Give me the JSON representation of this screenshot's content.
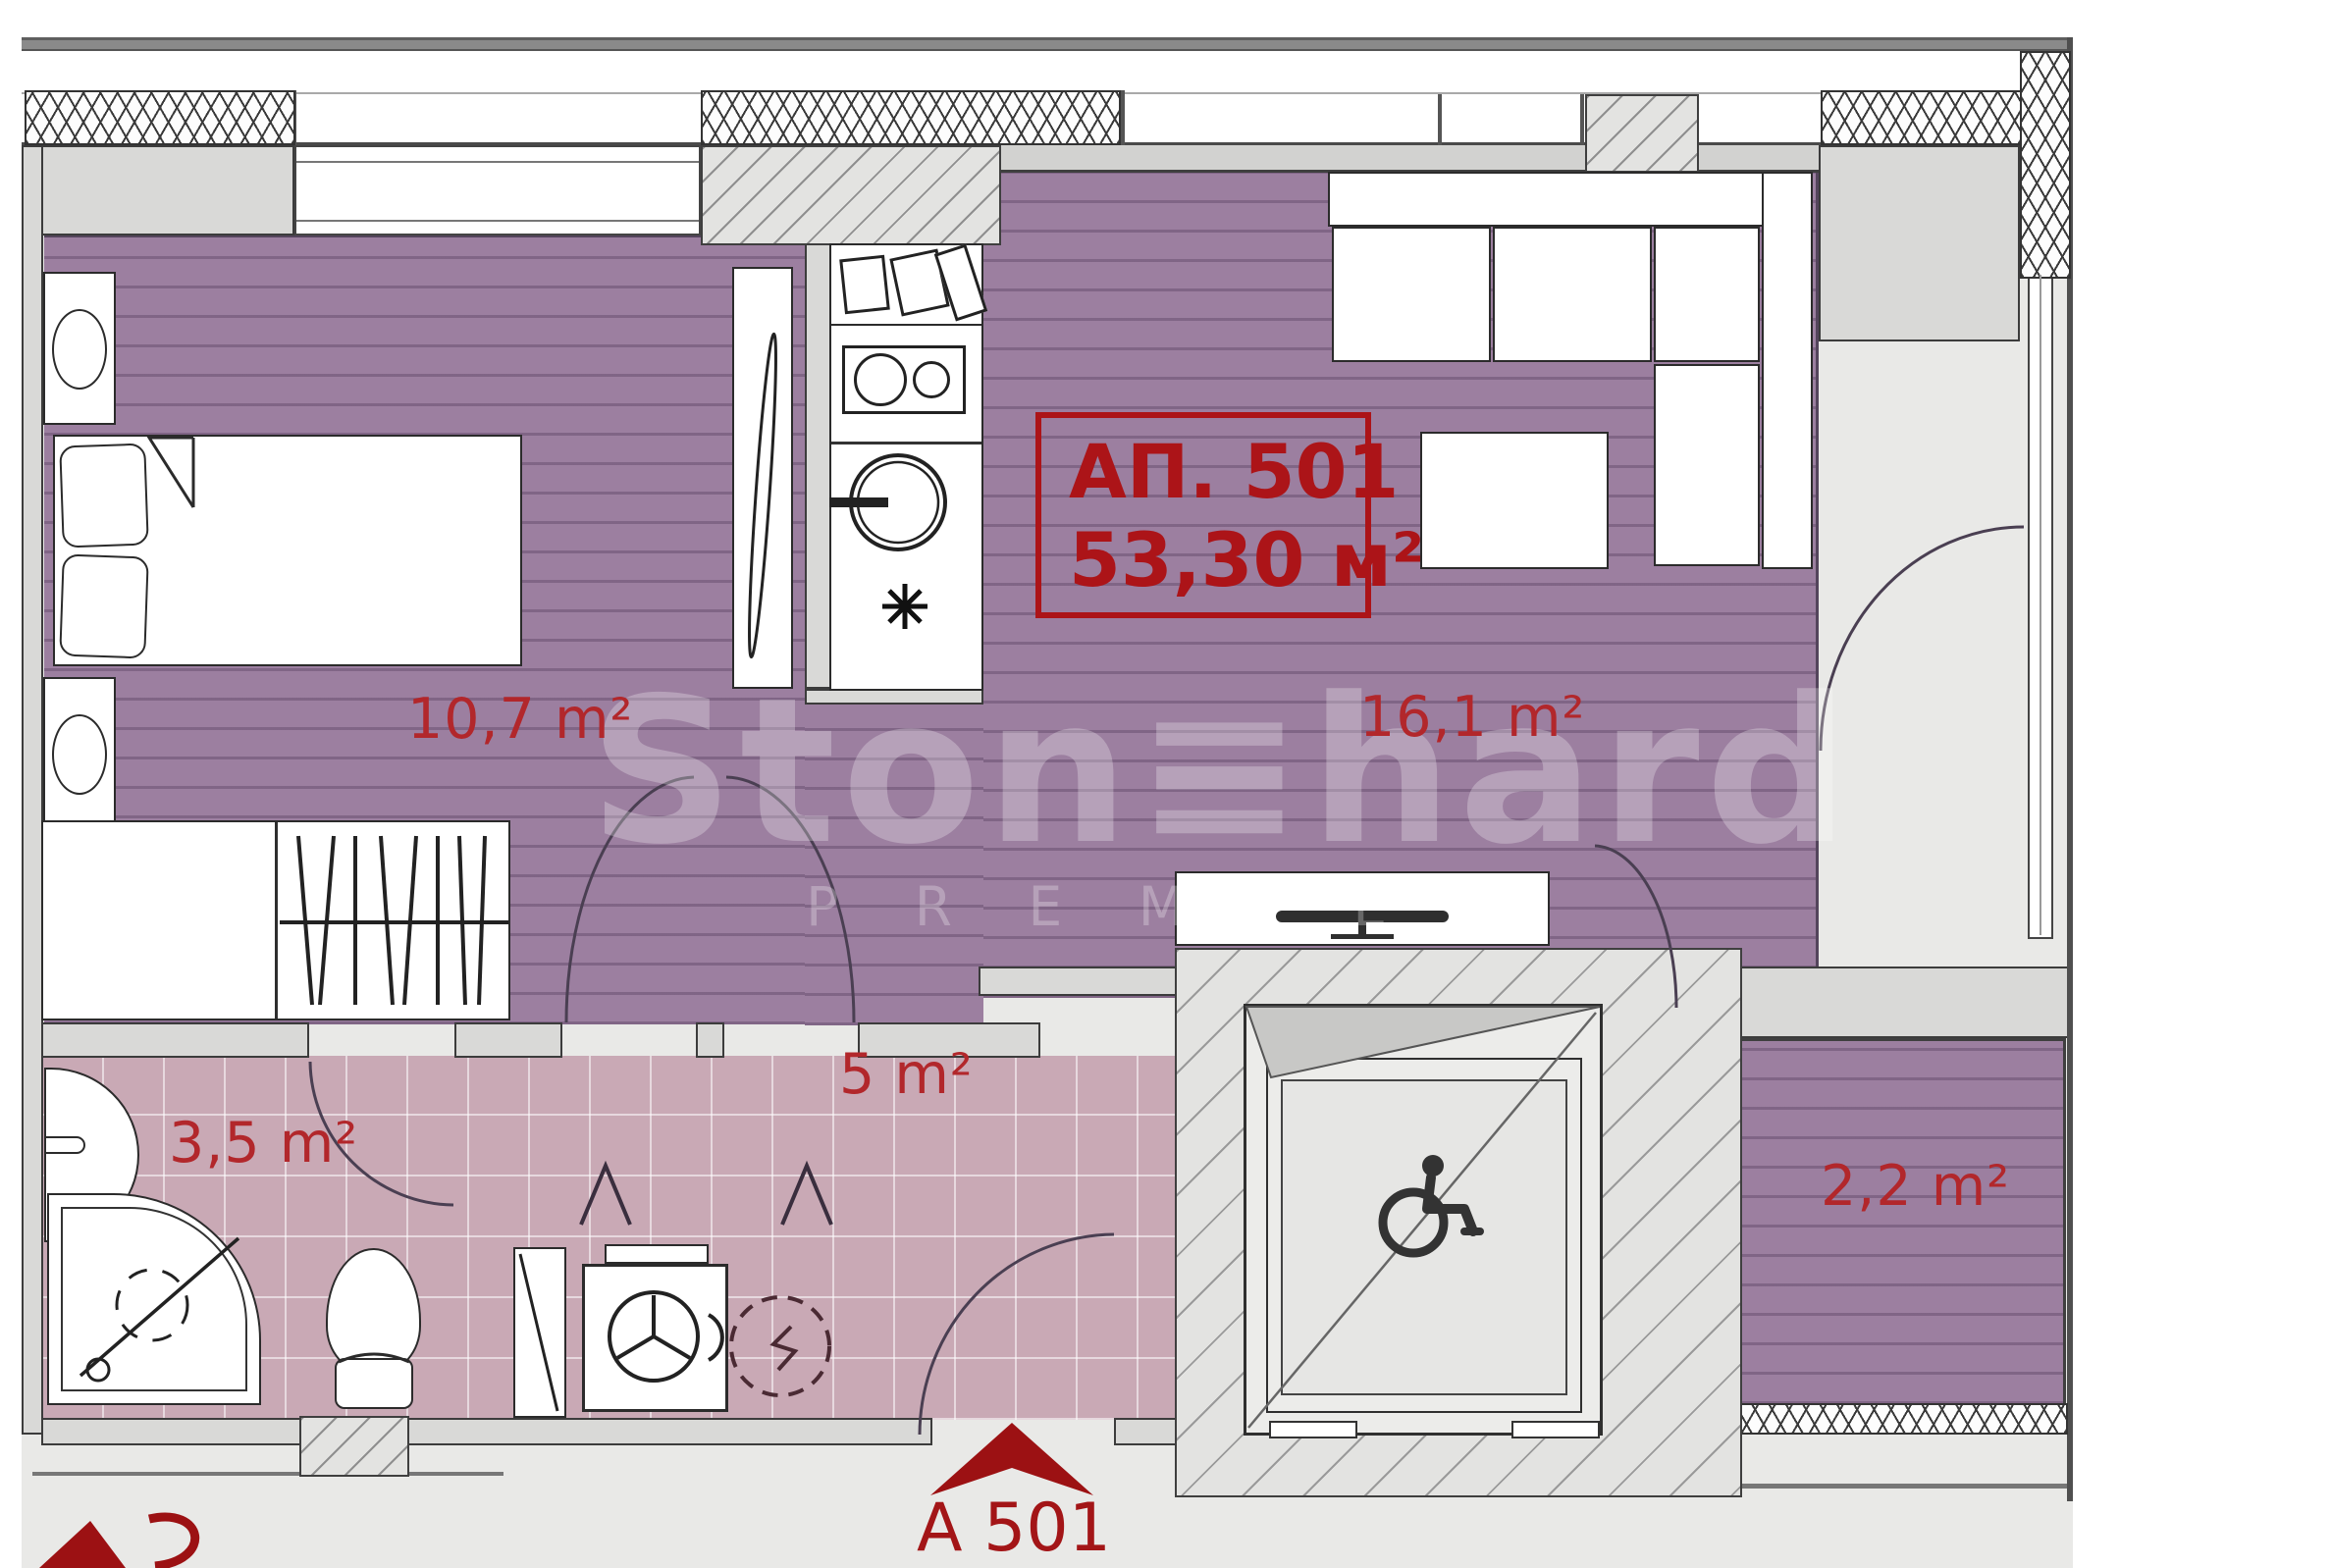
{
  "apartment_box": {
    "number": "АП. 501",
    "area": "53,30 м²"
  },
  "rooms": {
    "bedroom": {
      "area": "10,7 m²"
    },
    "living_room": {
      "area": "16,1 m²"
    },
    "bathroom": {
      "area": "3,5 m²"
    },
    "hallway": {
      "area": "5 m²"
    },
    "balcony": {
      "area": "2,2 m²"
    }
  },
  "entrance": {
    "label": "А 501"
  },
  "watermark": {
    "brand": "Ston≡hard",
    "sub": "P R E M I E R"
  },
  "colors": {
    "accent_red": "#b2272b",
    "label_dark_red": "#a31517",
    "floor_purple": "#9c7fa0",
    "floor_pink": "#c9a9b5",
    "wall_gray": "#d9d9d7"
  }
}
